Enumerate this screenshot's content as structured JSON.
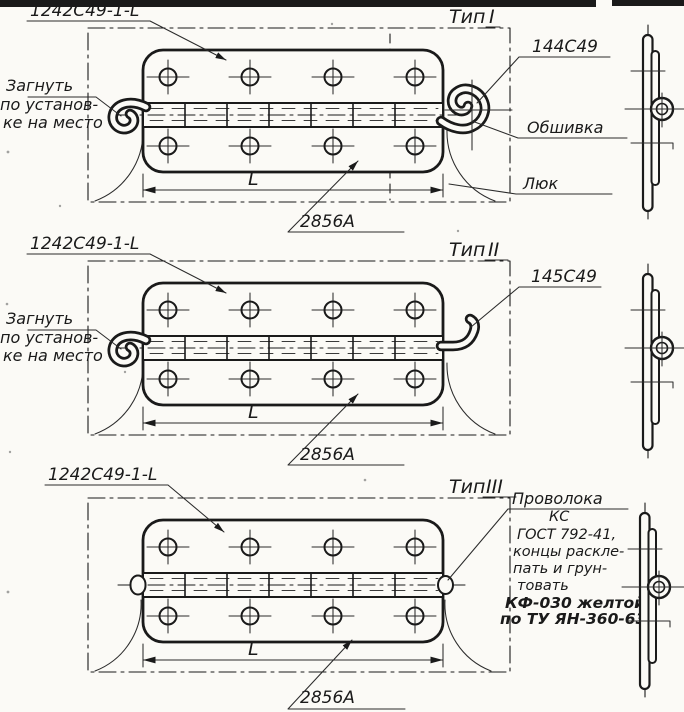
{
  "colors": {
    "ink": "#1a1a1a",
    "paper": "#fbfaf6"
  },
  "sections": [
    {
      "id": "type-1",
      "part_label": "1242С49-1-L",
      "type_word": "Тип",
      "type_numeral": "I",
      "bend_note_lines": [
        "Загнуть",
        "по установ-",
        "ке на место"
      ],
      "pin_label": "144С49",
      "skin_label": "Обшивка",
      "hatch_label": "Люк",
      "dim_label": "L",
      "detail_label": "2856А"
    },
    {
      "id": "type-2",
      "part_label": "1242С49-1-L",
      "type_word": "Тип",
      "type_numeral": "II",
      "bend_note_lines": [
        "Загнуть",
        "по установ-",
        "ке на место"
      ],
      "pin_label": "145С49",
      "dim_label": "L",
      "detail_label": "2856А"
    },
    {
      "id": "type-3",
      "part_label": "1242С49-1-L",
      "type_word": "Тип",
      "type_numeral": "III",
      "wire_note_lines": [
        "Проволока",
        "КС",
        "ГОСТ 792-41,",
        "концы раскле-",
        "пать и грун-",
        "товать",
        "КФ-030 желтой",
        "по ТУ ЯН-360-63"
      ],
      "dim_label": "L",
      "detail_label": "2856А"
    }
  ]
}
